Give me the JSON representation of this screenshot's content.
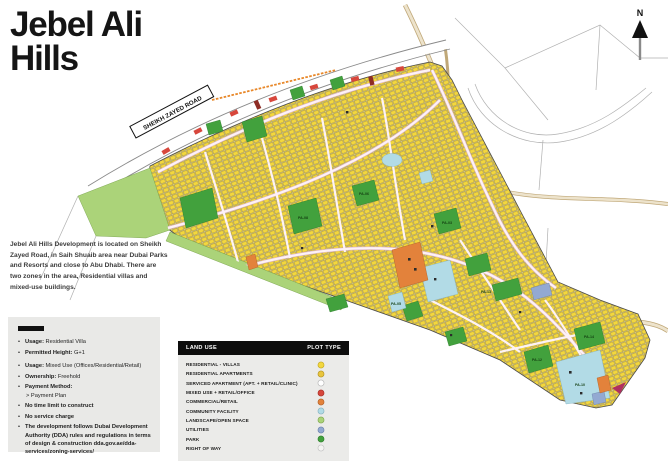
{
  "header": {
    "title_line1": "Jebel Ali",
    "title_line2": "Hills"
  },
  "description": "Jebel Ali Hills Development is located on Sheikh Zayed Road, in Saih Shuaib area near Dubai Parks and Resorts and close to Abu Dhabi. There are two zones in the area, Residential villas and mixed-use buildings.",
  "info_box": {
    "items": [
      {
        "b": "Usage:",
        "t": " Residential Villa"
      },
      {
        "b": "Permitted Height:",
        "t": " G+1"
      },
      {
        "b": "Usage:",
        "t": " Mixed Use (Offices/Residential/Retail)"
      },
      {
        "b": "Ownership:",
        "t": " Freehold"
      },
      {
        "b": "Payment Method:",
        "t": "",
        "sub": "> Payment Plan"
      },
      {
        "b": "No time limit to construct",
        "t": ""
      },
      {
        "b": "No service charge",
        "t": ""
      },
      {
        "b": "The development follows Dubai Development Authority (DDA) rules and regulations in terms of design & construction dda.gov.ae/dda-services/zoning-services/",
        "t": ""
      }
    ]
  },
  "legend": {
    "land_use_header": "LAND USE",
    "plot_type_header": "PLOT TYPE",
    "rows": [
      {
        "label": "RESIDENTIAL - VILLAS",
        "color": "#f3d73e",
        "border": "#c3a81f"
      },
      {
        "label": "RESIDENTIAL APARTMENTS",
        "color": "#e9c53d",
        "border": "#b2921f"
      },
      {
        "label": "SERVICED APARTMENT (APT. + RETAIL/CLINIC)",
        "color": "#ffffff",
        "border": "#b5b5b5"
      },
      {
        "label": "MIXED USE + RETAIL/OFFICE",
        "color": "#d7473c",
        "border": "#a62d23"
      },
      {
        "label": "COMMERCIAL/RETAIL",
        "color": "#e3823b",
        "border": "#b15e24"
      },
      {
        "label": "COMMUNITY FACILITY",
        "color": "#b2dbe6",
        "border": "#83b1bf"
      },
      {
        "label": "LANDSCAPE/OPEN SPACE",
        "color": "#abd379",
        "border": "#7da64c"
      },
      {
        "label": "UTILITIES",
        "color": "#93a9d2",
        "border": "#6a81ab"
      },
      {
        "label": "PARK",
        "color": "#42a13d",
        "border": "#2b7c29"
      },
      {
        "label": "RIGHT OF WAY",
        "color": "#f4f4f2",
        "border": "#c0c0c0"
      }
    ]
  },
  "map": {
    "road_label": "SHEIKH ZAYED ROAD",
    "north_label": "N",
    "area_labels": [
      {
        "id": "PA-03"
      },
      {
        "id": "PA-05"
      },
      {
        "id": "PA-06"
      },
      {
        "id": "PA-08"
      },
      {
        "id": "PA-10"
      },
      {
        "id": "PA-12"
      },
      {
        "id": "PA-13"
      },
      {
        "id": "PA-14"
      }
    ]
  }
}
